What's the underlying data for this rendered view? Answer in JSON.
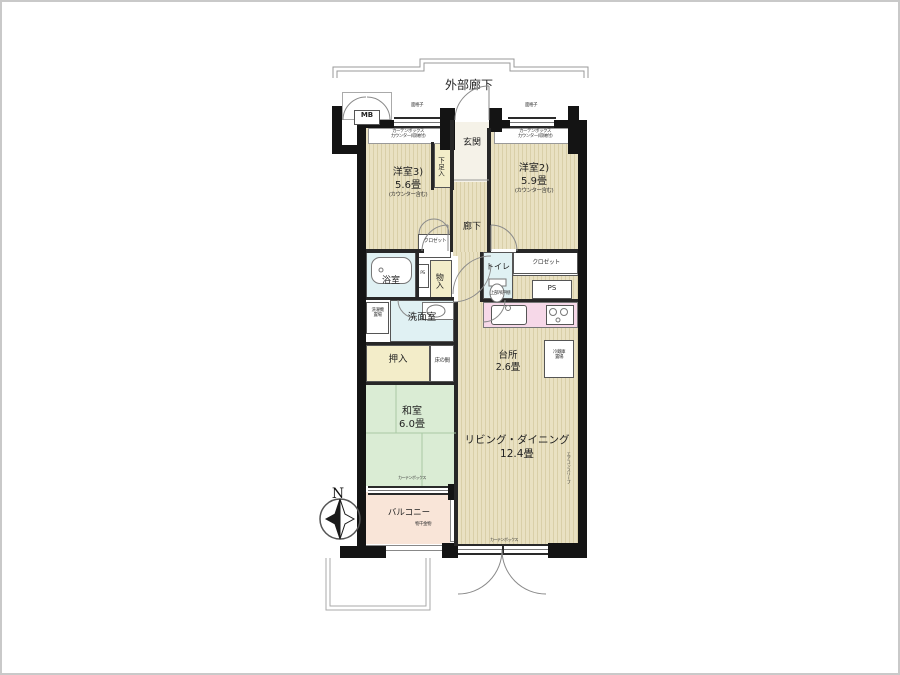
{
  "corridor": {
    "label": "外部廊下"
  },
  "compass": {
    "north": "N"
  },
  "rooms": {
    "western3": {
      "line1": "洋室3)",
      "line2": "5.6畳",
      "line3": "(カウンター含む)"
    },
    "western2": {
      "line1": "洋室2)",
      "line2": "5.9畳",
      "line3": "(カウンター含む)"
    },
    "entrance": {
      "label": "玄関"
    },
    "shoebox": {
      "label": "下足入"
    },
    "hallway": {
      "label": "廊下"
    },
    "closet_hall": {
      "label": "クロゼット"
    },
    "closet_west2": {
      "label": "クロゼット"
    },
    "storage": {
      "label": "物入"
    },
    "bath": {
      "label": "浴室"
    },
    "toilet": {
      "label": "トイレ"
    },
    "washroom": {
      "label": "洗面室"
    },
    "futon_closet": {
      "label": "押入"
    },
    "tokonoma": {
      "label": "床の間"
    },
    "japanese": {
      "line1": "和室",
      "line2": "6.0畳"
    },
    "kitchen": {
      "line1": "台所",
      "line2": "2.6畳"
    },
    "living": {
      "line1": "リビング・ダイニング",
      "line2": "12.4畳"
    },
    "balcony": {
      "label": "バルコニー",
      "note": "物干金物"
    }
  },
  "small": {
    "mb": "MB",
    "ps_a": "PS",
    "ps_b": "PS",
    "grille_left": "面格子",
    "grille_right": "面格子",
    "curtain_w3_1": "カーテンボックス",
    "curtain_w3_2": "カウンター(収納付)",
    "curtain_w2_1": "カーテンボックス",
    "curtain_w2_2": "カウンター(収納付)",
    "upper_cabinet": "上部吊戸棚",
    "washer_1": "洗濯機",
    "washer_2": "置場",
    "fridge_1": "冷蔵庫",
    "fridge_2": "置場",
    "curtain_tatami": "カーテンボックス",
    "curtain_ld": "カーテンボックス",
    "ac_sleeve": "エアコンスリーブ"
  },
  "colors": {
    "wall": "#141414",
    "flooring": "#e9e1c2",
    "tatami": "#daecd4",
    "wet_area": "#e0f1f3",
    "balcony": "#f9e5d8",
    "kitchen_counter": "#f6d8e8"
  }
}
